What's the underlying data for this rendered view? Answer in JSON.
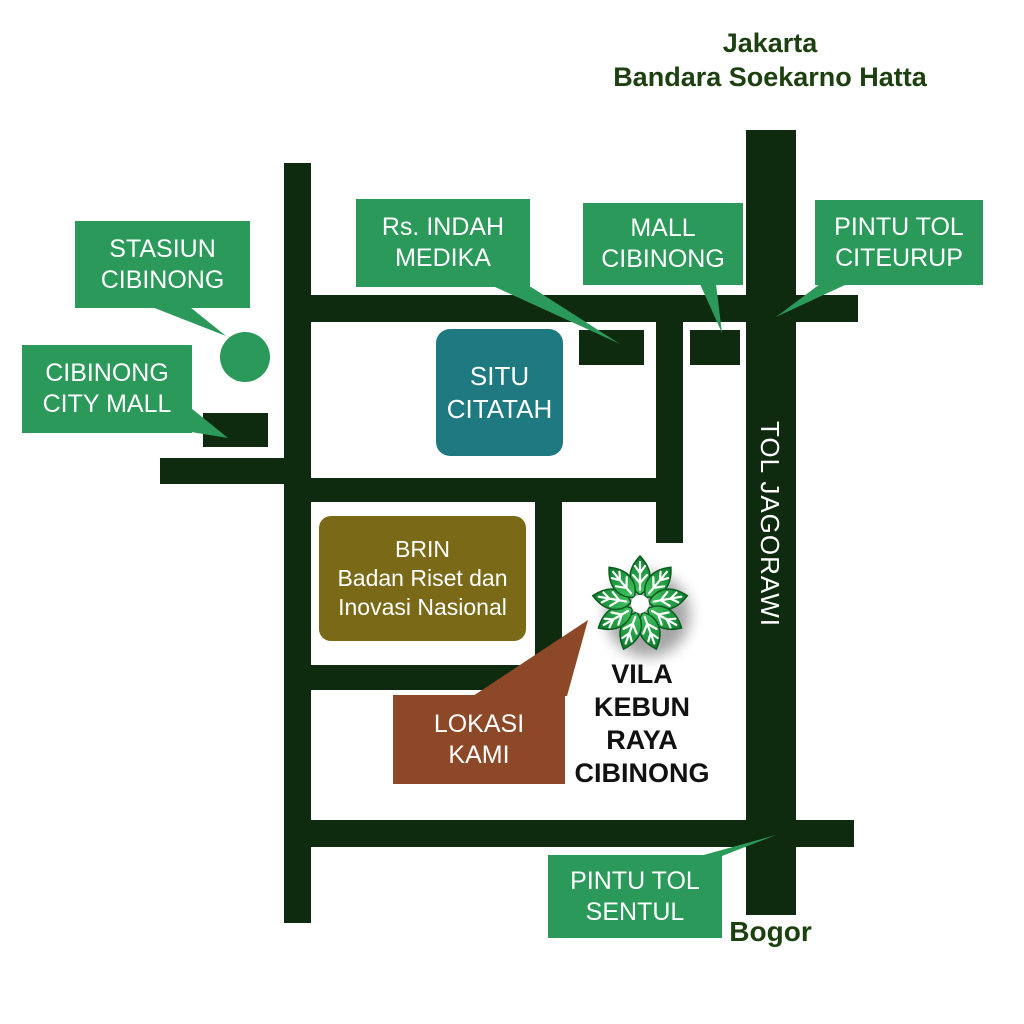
{
  "title": {
    "text": "Jakarta\nBandara Soekarno Hatta"
  },
  "destinations": {
    "south": "Bogor"
  },
  "highway": {
    "label": "TOL JAGORAWI"
  },
  "callouts": {
    "stasiun_cibinong": "STASIUN\nCIBINONG",
    "cibinong_city_mall": "CIBINONG\nCITY MALL",
    "rs_indah_medika": "Rs. INDAH\nMEDIKA",
    "mall_cibinong": "MALL\nCIBINONG",
    "pintu_tol_citeurup": "PINTU TOL\nCITEURUP",
    "pintu_tol_sentul": "PINTU TOL\nSENTUL"
  },
  "places": {
    "situ_citatah": "SITU\nCITATAH",
    "brin": "BRIN\nBadan Riset dan\nInovasi Nasional",
    "lokasi_kami": "LOKASI\nKAMI",
    "vila_kebun_raya_cibinong": "VILA\nKEBUN\nRAYA\nCIBINONG"
  },
  "icons": {
    "logo": "flower-leaf-rosette-logo",
    "station_marker": "green-circle-marker"
  },
  "colors": {
    "road": "#0E2A0F",
    "callout_green": "#2B9959",
    "teal": "#1E7A80",
    "olive": "#7A6A18",
    "brown": "#8C4827",
    "title_text": "#1C400F",
    "label_text": "#FFFFFF",
    "place_text": "#111111",
    "leaf_light": "#45C763",
    "leaf_dark": "#0B7C2B"
  }
}
